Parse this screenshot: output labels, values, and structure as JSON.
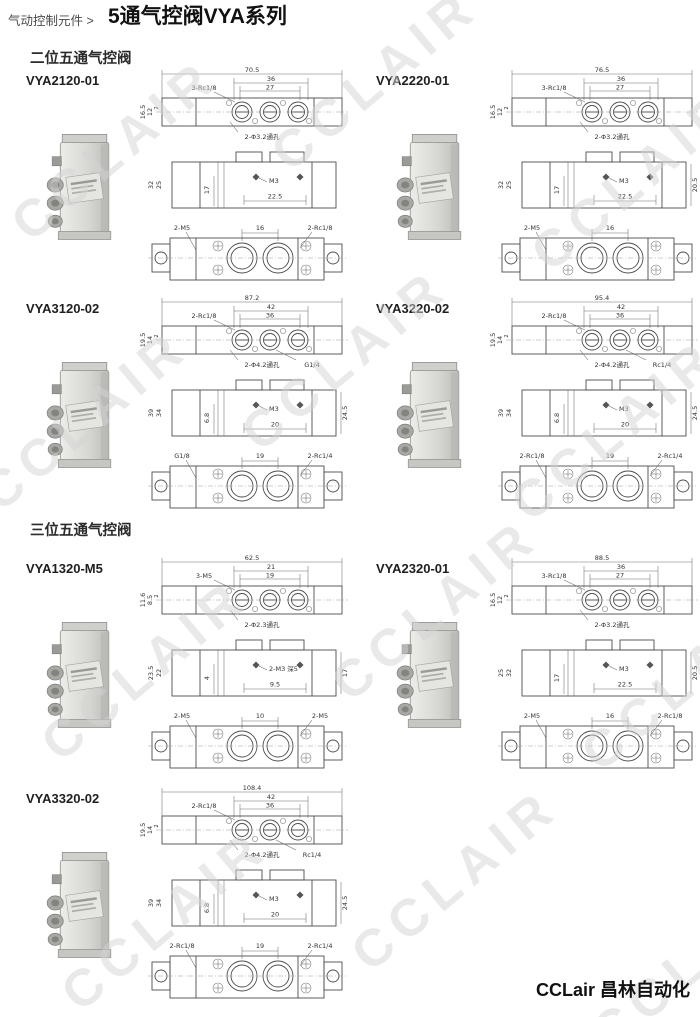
{
  "header": {
    "breadcrumb": "气动控制元件 >",
    "title": "5通气控阀VYA系列"
  },
  "sections": {
    "two_position": "二位五通气控阀",
    "three_position": "三位五通气控阀"
  },
  "watermark": {
    "text": "CCLAIR",
    "color": "#d4d4d4"
  },
  "footer": {
    "brand": "CCLair 昌林自动化"
  },
  "valves": [
    {
      "code": "VYA2120-01",
      "top": {
        "total": "70.5",
        "pitch_outer": "36",
        "pitch_inner": "27",
        "thread": "3-Rc1/8",
        "h1": "16.5",
        "h2": "12",
        "h3": "2",
        "hole_note": "2-Φ3.2通孔",
        "port_note": ""
      },
      "side": {
        "h1": "32",
        "h2": "25",
        "d1": "17",
        "thread": "M3",
        "pitch": "22.5",
        "right": ""
      },
      "bottom": {
        "left": "2-M5",
        "pitch": "16",
        "right": "2-Rc1/8"
      }
    },
    {
      "code": "VYA2220-01",
      "top": {
        "total": "76.5",
        "pitch_outer": "36",
        "pitch_inner": "27",
        "thread": "3-Rc1/8",
        "h1": "16.5",
        "h2": "12",
        "h3": "2",
        "hole_note": "2-Φ3.2通孔",
        "port_note": ""
      },
      "side": {
        "h1": "32",
        "h2": "25",
        "d1": "17",
        "thread": "M3",
        "pitch": "22.5",
        "right": "20.5"
      },
      "bottom": {
        "left": "2-M5",
        "pitch": "16",
        "right": ""
      }
    },
    {
      "code": "VYA3120-02",
      "top": {
        "total": "87.2",
        "pitch_outer": "42",
        "pitch_inner": "36",
        "thread": "2-Rc1/8",
        "h1": "19.5",
        "h2": "14",
        "h3": "2",
        "hole_note": "2-Φ4.2通孔",
        "port_note": "G1/4"
      },
      "side": {
        "h1": "39",
        "h2": "34",
        "d1": "6.8",
        "thread": "M3",
        "pitch": "20",
        "right": "24.5"
      },
      "bottom": {
        "left": "G1/8",
        "pitch": "19",
        "right": "2-Rc1/4"
      }
    },
    {
      "code": "VYA3220-02",
      "top": {
        "total": "95.4",
        "pitch_outer": "42",
        "pitch_inner": "36",
        "thread": "2-Rc1/8",
        "h1": "19.5",
        "h2": "14",
        "h3": "2",
        "hole_note": "2-Φ4.2通孔",
        "port_note": "Rc1/4"
      },
      "side": {
        "h1": "39",
        "h2": "34",
        "d1": "6.8",
        "thread": "M3",
        "pitch": "20",
        "right": "24.5"
      },
      "bottom": {
        "left": "2-Rc1/8",
        "pitch": "19",
        "right": "2-Rc1/4"
      }
    },
    {
      "code": "VYA1320-M5",
      "top": {
        "total": "62.5",
        "pitch_outer": "21",
        "pitch_inner": "19",
        "thread": "3-M5",
        "h1": "11.6",
        "h2": "8.5",
        "h3": "2",
        "hole_note": "2-Φ2.3通孔",
        "port_note": ""
      },
      "side": {
        "h1": "23.5",
        "h2": "22",
        "d1": "4",
        "thread": "2-M3 深5",
        "pitch": "9.5",
        "right": "17"
      },
      "bottom": {
        "left": "2-M5",
        "pitch": "10",
        "right": "2-M5"
      }
    },
    {
      "code": "VYA2320-01",
      "top": {
        "total": "88.5",
        "pitch_outer": "36",
        "pitch_inner": "27",
        "thread": "3-Rc1/8",
        "h1": "16.5",
        "h2": "12",
        "h3": "2",
        "hole_note": "2-Φ3.2通孔",
        "port_note": ""
      },
      "side": {
        "h1": "25",
        "h2": "32",
        "d1": "17",
        "thread": "M3",
        "pitch": "22.5",
        "right": "20.5"
      },
      "bottom": {
        "left": "2-M5",
        "pitch": "16",
        "right": "2-Rc1/8"
      }
    },
    {
      "code": "VYA3320-02",
      "top": {
        "total": "108.4",
        "pitch_outer": "42",
        "pitch_inner": "36",
        "thread": "2-Rc1/8",
        "h1": "19.5",
        "h2": "14",
        "h3": "2",
        "hole_note": "2-Φ4.2通孔",
        "port_note": "Rc1/4"
      },
      "side": {
        "h1": "39",
        "h2": "34",
        "d1": "6.8",
        "thread": "M3",
        "pitch": "20",
        "right": "24.5"
      },
      "bottom": {
        "left": "2-Rc1/8",
        "pitch": "19",
        "right": "2-Rc1/4"
      }
    }
  ]
}
